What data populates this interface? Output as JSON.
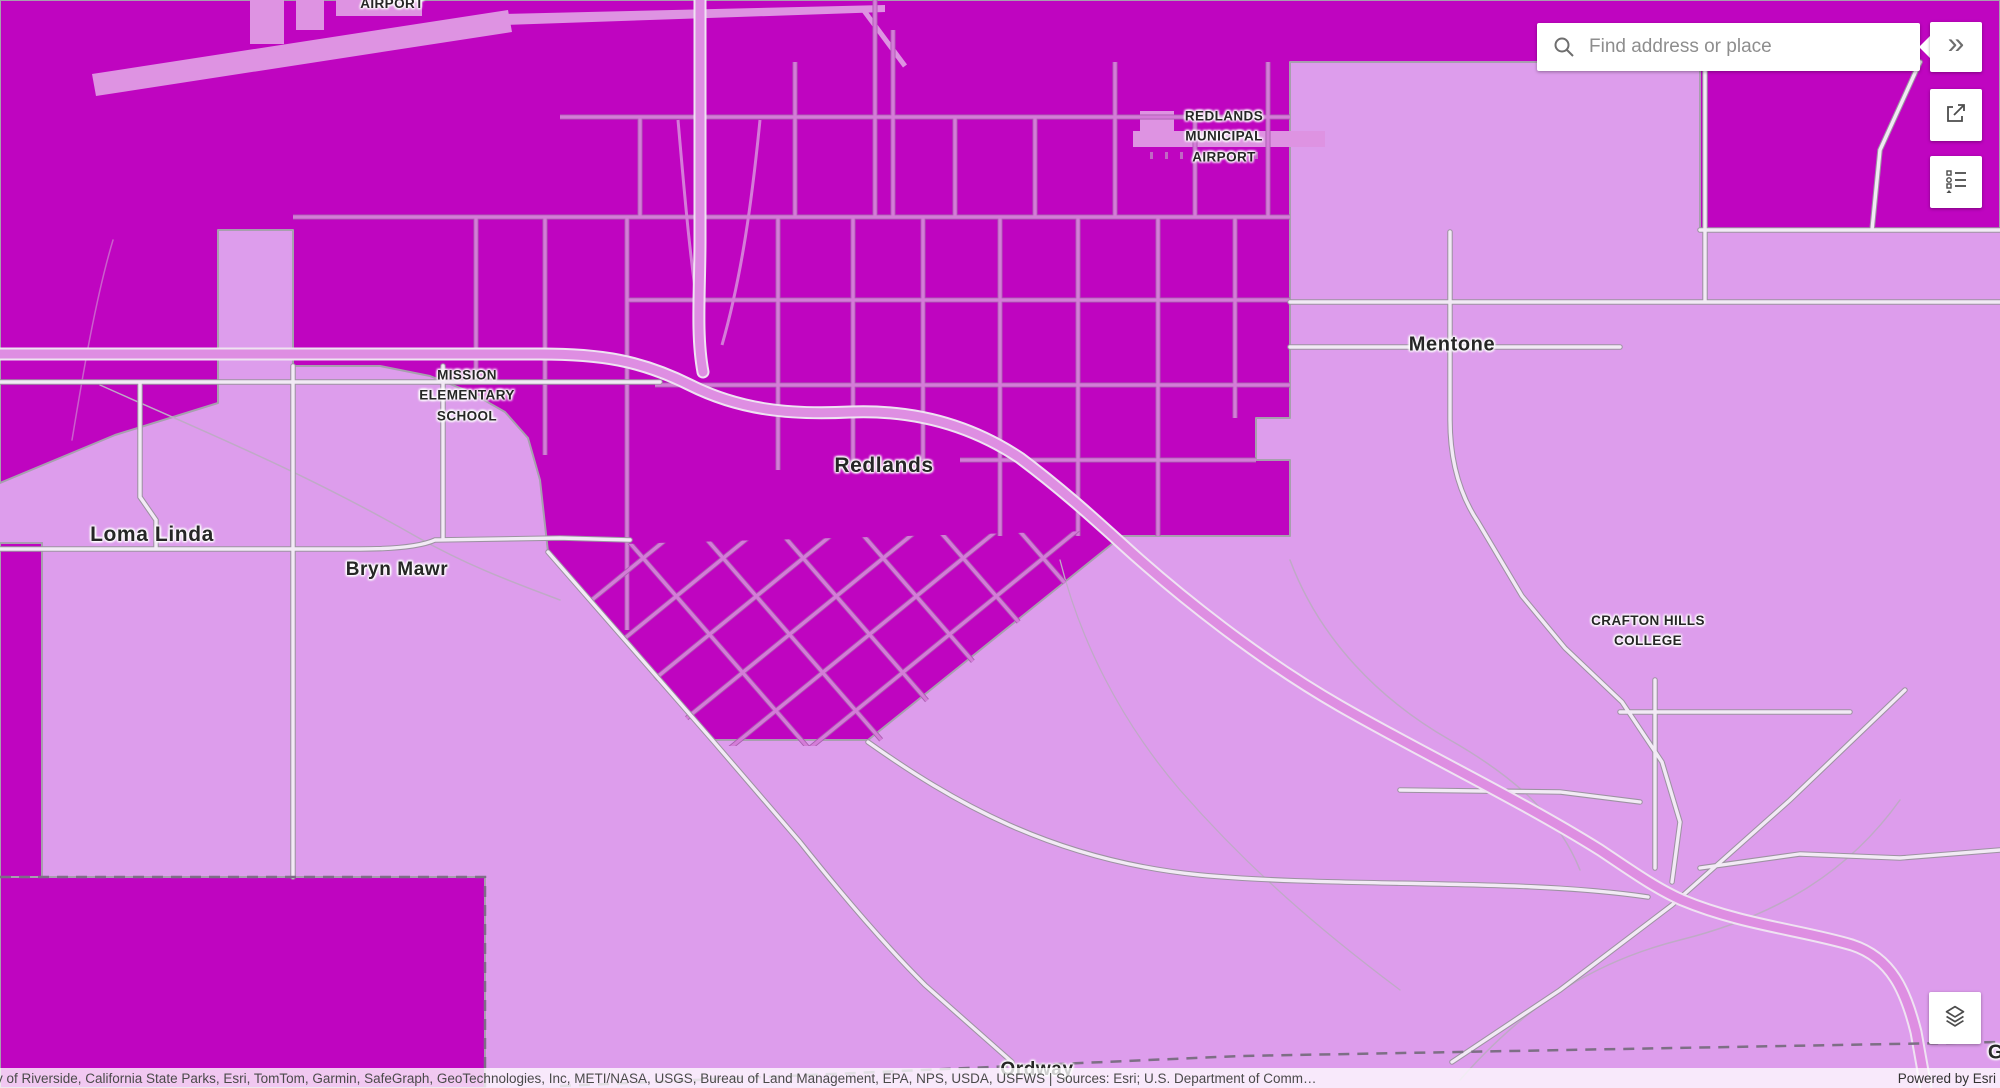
{
  "search": {
    "placeholder": "Find address or place"
  },
  "controls": {
    "expand_label": "»"
  },
  "attribution": {
    "sources": "y of Riverside, California State Parks, Esri, TomTom, Garmin, SafeGraph, GeoTechnologies, Inc, METI/NASA, USGS, Bureau of Land Management, EPA, NPS, USDA, USFWS | Sources: Esri; U.S. Department of Comm…",
    "powered_by": "Powered by Esri"
  },
  "map": {
    "colors": {
      "zone_dark": "#bf05c0",
      "zone_light": "#dd9dec",
      "road_on_dark": "#d47cd8",
      "road_light": "#f2eaf5",
      "freeway_fill": "#de8ee2",
      "boundary_gray": "#a79fae",
      "label_color": "#262626"
    },
    "labels": {
      "airport_partial": "AIRPORT",
      "redlands_municipal_airport": "REDLANDS\nMUNICIPAL\nAIRPORT",
      "mission_elementary_school": "MISSION\nELEMENTARY\nSCHOOL",
      "crafton_hills_college": "CRAFTON HILLS\nCOLLEGE",
      "redlands": "Redlands",
      "loma_linda": "Loma Linda",
      "bryn_mawr": "Bryn Mawr",
      "mentone": "Mentone",
      "ordway": "Ordway",
      "partial_east": "G"
    }
  }
}
